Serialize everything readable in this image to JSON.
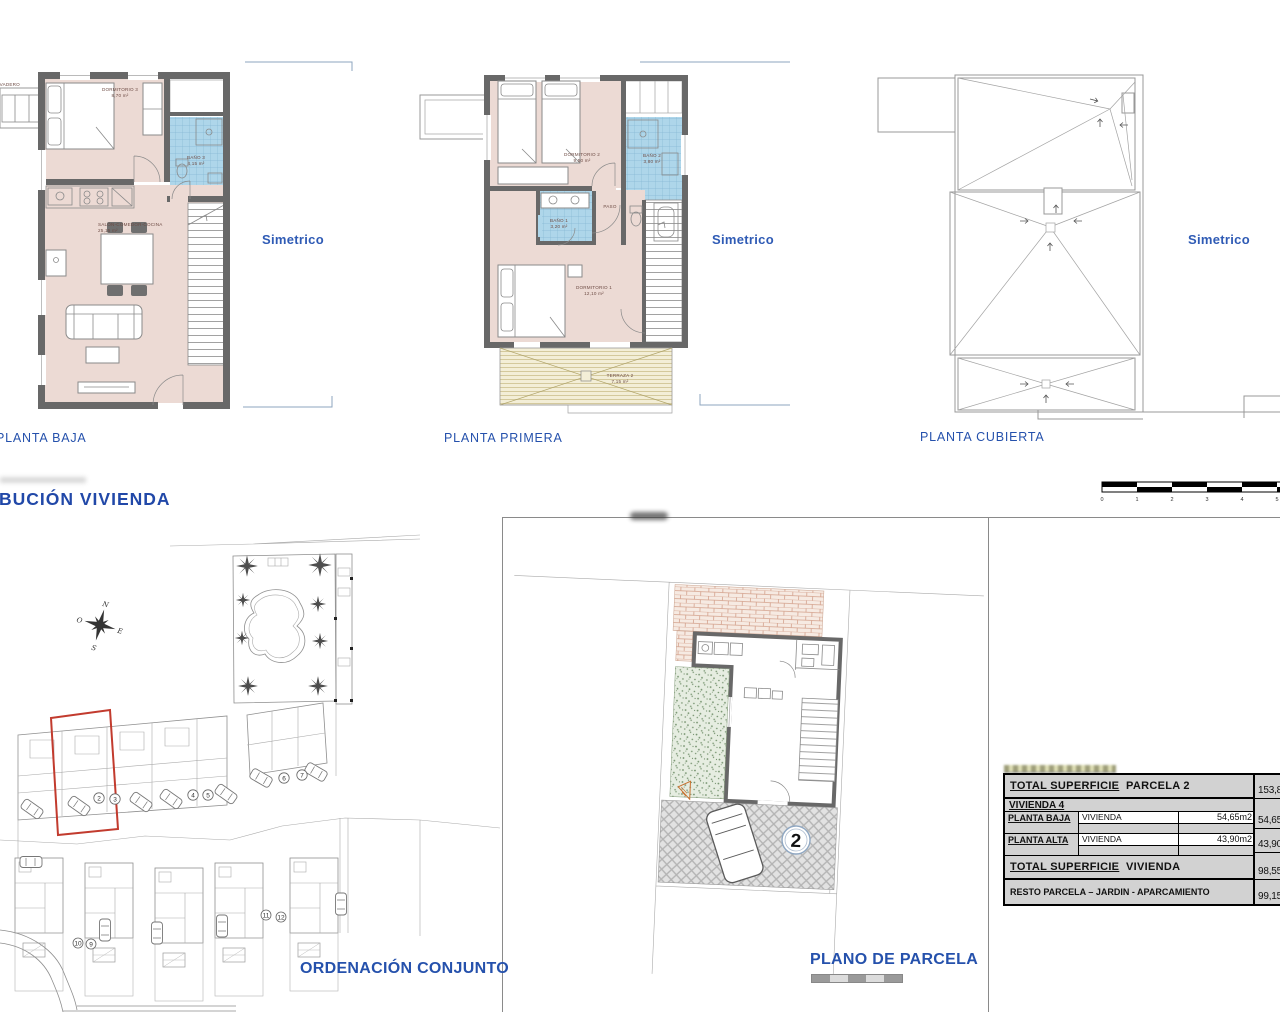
{
  "titles": {
    "distribucion": "BUCIÓN  VIVIENDA",
    "planta_baja": "PLANTA BAJA",
    "planta_primera": "PLANTA PRIMERA",
    "planta_cubierta": "PLANTA CUBIERTA",
    "ordenacion": "ORDENACIÓN CONJUNTO",
    "plano_parcela": "PLANO DE PARCELA",
    "simetrico": "Simetrico"
  },
  "planta_baja": {
    "lavadero": "LAVADERO",
    "dormitorio3_name": "DORMITORIO 3",
    "dormitorio3_area": "8,70 m²",
    "bano3_name": "BAÑO 3",
    "bano3_area": "4,15 m²",
    "salon_name": "SALÓN-COMEDOR-COCINA",
    "salon_area": "25,15 m²"
  },
  "planta_primera": {
    "dormitorio2_name": "DORMITORIO 2",
    "dormitorio2_area": "9,50 m²",
    "bano2_name": "BAÑO 2",
    "bano2_area": "3,80 m²",
    "bano1_name": "BAÑO 1",
    "bano1_area": "3,20 m²",
    "paso": "PASO",
    "dormitorio1_name": "DORMITORIO 1",
    "dormitorio1_area": "12,10 m²",
    "terraza_name": "TERRAZA 2",
    "terraza_area": "7,15 m²"
  },
  "scale_bar": {
    "ticks": [
      "0",
      "1",
      "2",
      "3",
      "4",
      "5"
    ]
  },
  "site_plan": {
    "compass": {
      "n": "N",
      "s": "S",
      "e": "E",
      "o": "O"
    },
    "row_units": [
      "2",
      "3",
      "4",
      "5",
      "6",
      "7"
    ],
    "lower_units": [
      "10",
      "9",
      "11",
      "12"
    ]
  },
  "parcel_plan": {
    "number": "2"
  },
  "table": {
    "r1_label_a": "TOTAL  SUPERFICIE",
    "r1_label_b": "PARCELA  2",
    "r1_value": "153,80m2",
    "r2_label": "VIVIENDA  4",
    "r3_label": "PLANTA  BAJA",
    "r3_use": "VIVIENDA",
    "r3_value": "54,65m2",
    "r3_total": "54,65m2",
    "r4_label": "PLANTA  ALTA",
    "r4_use": "VIVIENDA",
    "r4_value": "43,90m2",
    "r4_total": "43,90m2",
    "r5_label_a": "TOTAL  SUPERFICIE",
    "r5_label_b": "VIVIENDA",
    "r5_value": "98,55m2",
    "r6_label": "RESTO PARCELA – JARDIN - APARCAMIENTO",
    "r6_value": "99,15m2"
  }
}
